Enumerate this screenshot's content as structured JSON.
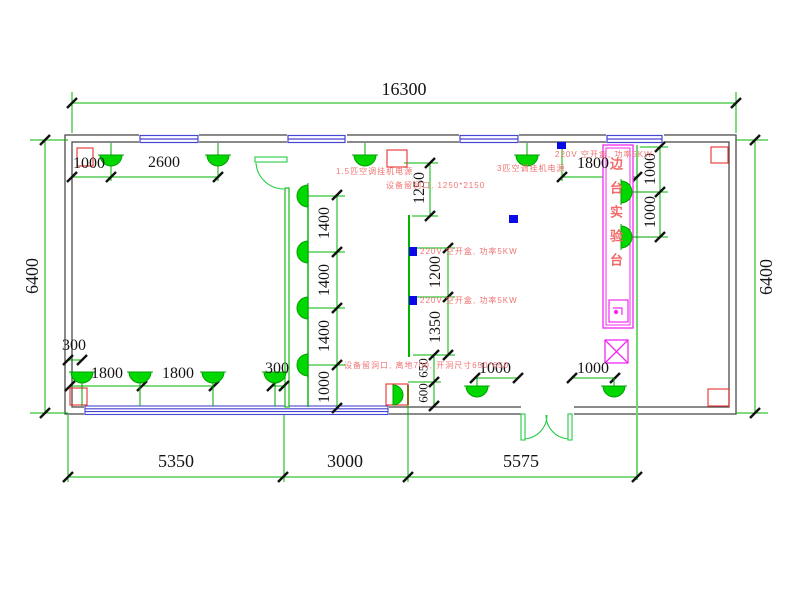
{
  "dims": {
    "total_width": "16300",
    "left_height": "6400",
    "right_height": "6400",
    "tl_a": "1000",
    "tl_b": "2600",
    "tr_a": "1800",
    "right_a": "1000",
    "right_b": "1000",
    "mid_a": "1250",
    "mid_b": "1200",
    "mid_c": "1350",
    "mid_d": "650",
    "mid_e": "600",
    "col_a": "1400",
    "col_b": "1400",
    "col_c": "1400",
    "col_d": "1000",
    "bl_a": "300",
    "bl_b": "1800",
    "bl_c": "1800",
    "bl_d": "300",
    "br_a": "1000",
    "br_b": "1000",
    "bottom_a": "5350",
    "bottom_b": "3000",
    "bottom_c": "5575"
  },
  "annotations": {
    "ac_small": "1.5匹空调挂机电源",
    "ac_large": "3匹空调挂机电源",
    "hole_top": "设备留洞口, 1250*2150",
    "hole_bottom": "设备留洞口, 离地700, 开洞尺寸650*650",
    "outlet_top": "220V 空开盒, 功率5KW",
    "outlet_mid_upper": "220V 空开盒, 功率5KW",
    "outlet_mid_lower": "220V 空开盒, 功率5KW",
    "bench": "边台实验台"
  },
  "colors": {
    "dimension_green": "#00b400",
    "lamp_green": "#00d800",
    "wall_gray": "#4a4a4a",
    "window_blue": "#4646d2",
    "outlet_blue": "#0a0ae6",
    "annotation_red": "#f07474",
    "bench_magenta": "#f02bf0"
  }
}
